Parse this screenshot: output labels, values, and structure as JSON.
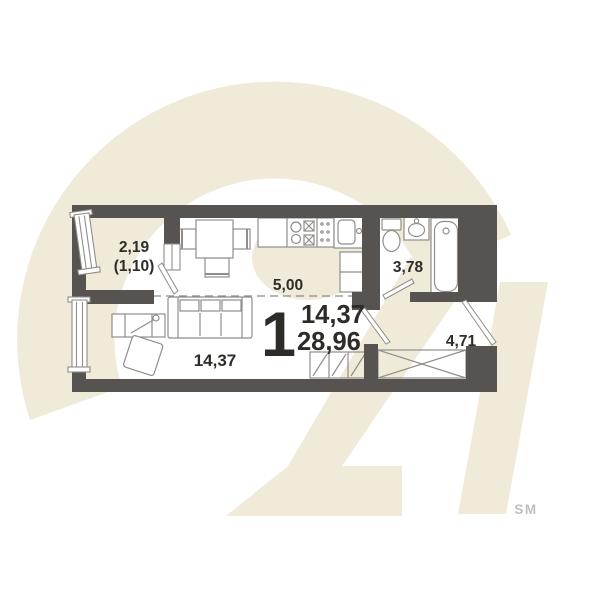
{
  "watermark": {
    "glyph": "21",
    "brand": "SM",
    "color": "#f0ead9",
    "brand_color": "#c0bfbb"
  },
  "plan": {
    "colors": {
      "wall": "#565350",
      "furniture": "#8f8e8a",
      "text": "#2d2c29",
      "dashed": "#8c8b87"
    },
    "labels": {
      "rooms_count": "1",
      "living_area": "14,37",
      "total_area": "28,96",
      "length": "5,00",
      "balcony_area": "2,19",
      "balcony_reduced": "(1,10)",
      "living_room_area": "14,37",
      "bathroom_area": "3,78",
      "hallway_area": "4,71"
    },
    "rooms": [
      {
        "name": "balcony",
        "area": "2,19",
        "area_reduced": "(1,10)"
      },
      {
        "name": "living-room",
        "area": "14,37"
      },
      {
        "name": "bathroom",
        "area": "3,78"
      },
      {
        "name": "hallway",
        "area": "4,71"
      }
    ]
  }
}
